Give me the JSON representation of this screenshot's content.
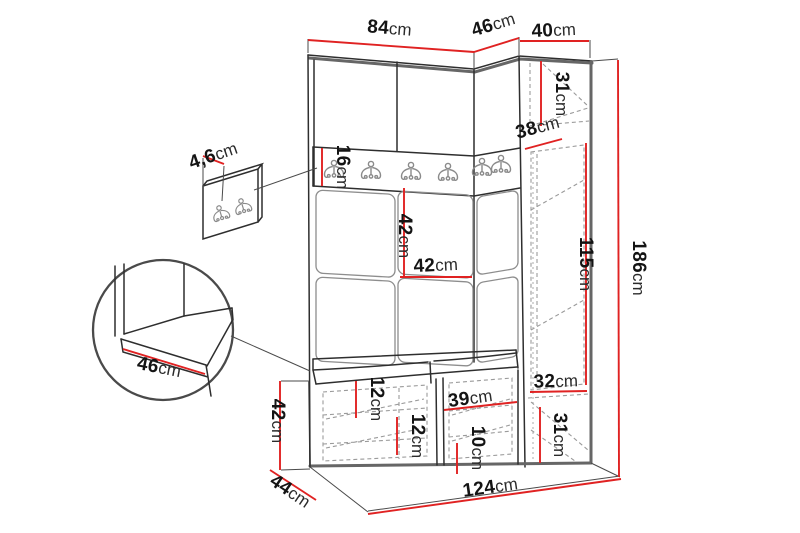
{
  "colors": {
    "dimension": "#e02222",
    "outline": "#2e2e2e",
    "edge": "#666666",
    "dash": "#9a9a9a"
  },
  "dims": {
    "width_left_section": {
      "v": "84",
      "u": "cm"
    },
    "width_corner_section": {
      "v": "46",
      "u": "cm"
    },
    "width_right_cabinet": {
      "v": "40",
      "u": "cm"
    },
    "height_total": {
      "v": "186",
      "u": "cm"
    },
    "cabinet_top_section": {
      "v": "31",
      "u": "cm"
    },
    "cabinet_top_depth": {
      "v": "38",
      "u": "cm"
    },
    "cabinet_door_height": {
      "v": "115",
      "u": "cm"
    },
    "cabinet_inner_width": {
      "v": "32",
      "u": "cm"
    },
    "cabinet_bottom_section": {
      "v": "31",
      "u": "cm"
    },
    "hook_rail_height": {
      "v": "16",
      "u": "cm"
    },
    "back_panel_height": {
      "v": "42",
      "u": "cm"
    },
    "back_panel_width": {
      "v": "42",
      "u": "cm"
    },
    "wall_panel_thickness": {
      "v": "4,6",
      "u": "cm"
    },
    "seat_depth_detail": {
      "v": "46",
      "u": "cm"
    },
    "bench_height": {
      "v": "42",
      "u": "cm"
    },
    "bench_depth": {
      "v": "44",
      "u": "cm"
    },
    "bench_shelf_top": {
      "v": "12",
      "u": "cm"
    },
    "bench_shelf_mid": {
      "v": "12",
      "u": "cm"
    },
    "bench_compartment_width": {
      "v": "39",
      "u": "cm"
    },
    "bench_shelf_bottom": {
      "v": "10",
      "u": "cm"
    },
    "width_total": {
      "v": "124",
      "u": "cm"
    }
  }
}
